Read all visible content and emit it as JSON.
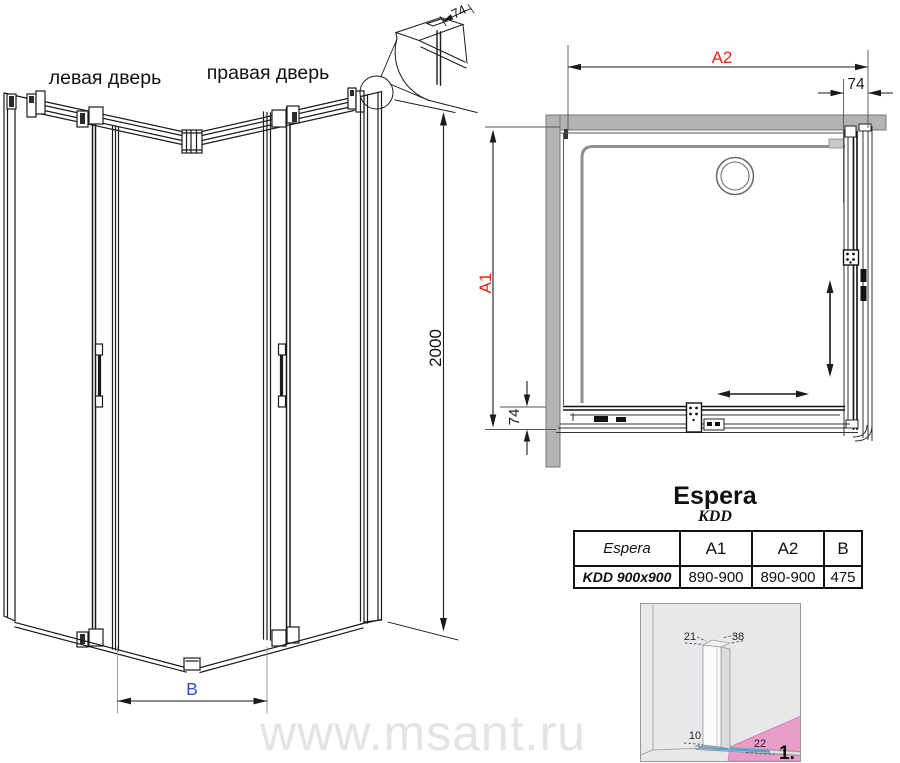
{
  "left_view": {
    "left_door_label": "левая дверь",
    "right_door_label": "правая дверь",
    "height_dim": "2000",
    "width_dim": "B",
    "profile_dim": "74"
  },
  "plan_view": {
    "a2_label": "A2",
    "a1_label": "A1",
    "top_right_dim": "74",
    "bottom_left_dim": "74"
  },
  "product": {
    "series": "Espera",
    "model": "KDD"
  },
  "spec_table": {
    "headers": [
      "Espera",
      "A1",
      "A2",
      "B"
    ],
    "row": [
      "KDD 900x900",
      "890-900",
      "890-900",
      "475"
    ]
  },
  "install_detail": {
    "width_top_left": "21",
    "width_top_right": "38",
    "gap_bottom_left": "10",
    "gap_bottom_right": "22",
    "step_number": "1."
  },
  "watermark": "www.msant.ru",
  "colors": {
    "dim_red": "#e8231a",
    "dim_blue": "#3050c8",
    "wall_gray": "#b4b4b4",
    "floor_pink": "#e79fc9",
    "sill_blue": "#3fa8da",
    "watermark_gray": "#e4e4e4",
    "line_black": "#1b1b1b"
  }
}
